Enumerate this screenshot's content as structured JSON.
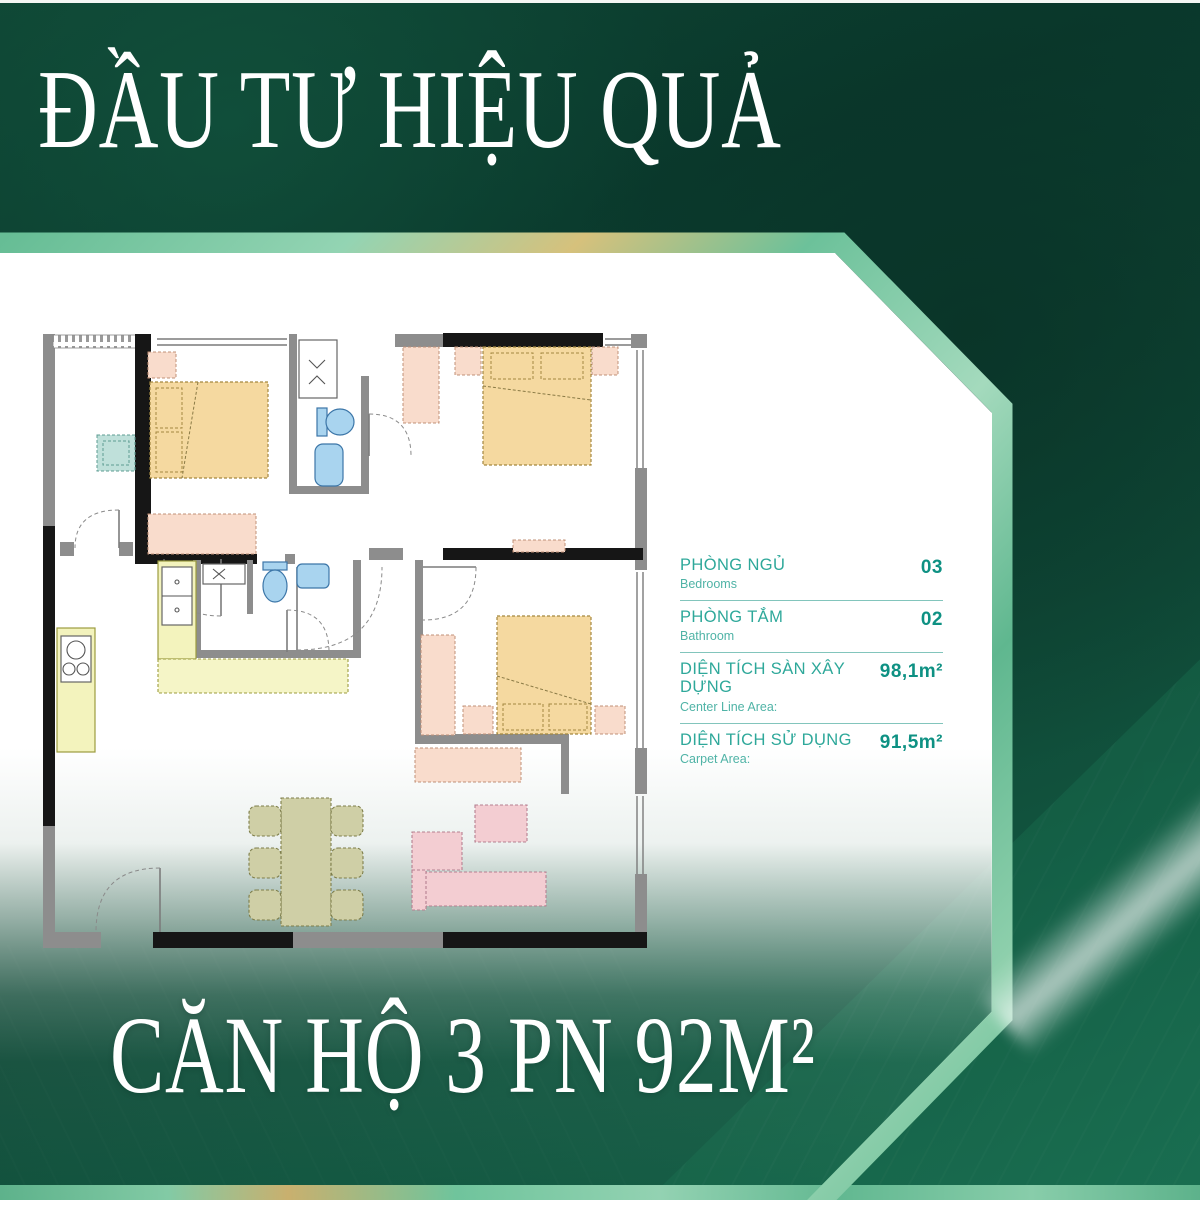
{
  "poster": {
    "title_top": "ĐẦU TƯ HIỆU QUẢ",
    "title_bottom": "CĂN HỘ 3 PN 92M²"
  },
  "specs": {
    "rows": [
      {
        "label": "PHÒNG NGỦ",
        "sublabel": "Bedrooms",
        "value": "03"
      },
      {
        "label": "PHÒNG TẮM",
        "sublabel": "Bathroom",
        "value": "02"
      },
      {
        "label": "DIỆN TÍCH SÀN XÂY DỰNG",
        "sublabel": "Center Line Area:",
        "value": "98,1m²"
      },
      {
        "label": "DIỆN TÍCH SỬ DỤNG",
        "sublabel": "Carpet Area:",
        "value": "91,5m²"
      }
    ]
  },
  "colors": {
    "background_green_dark": "#0b3e30",
    "accent_teal": "#2ea89a",
    "value_teal": "#0e9183",
    "plan_bed": "#f5d9a0",
    "plan_pink": "#f9dccc",
    "plan_kitchen": "#f3f3bd",
    "plan_fixture_blue": "#a9d4ef",
    "plan_dining": "#cfcfa6",
    "plan_sofa": "#f3cdd2",
    "plan_desk_teal": "#bfe0da"
  }
}
